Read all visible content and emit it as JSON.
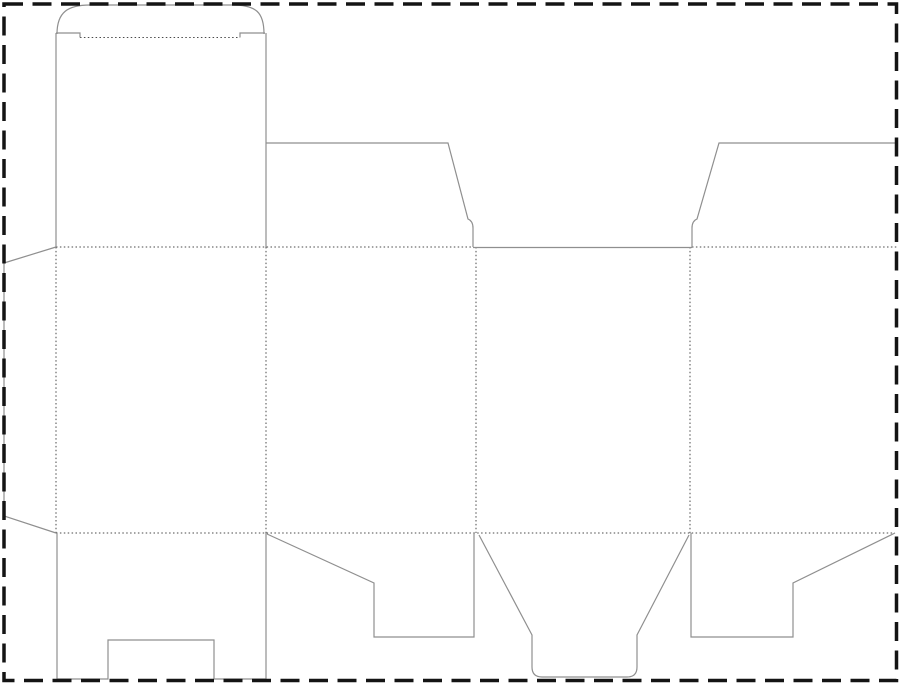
{
  "canvas": {
    "width": 900,
    "height": 685,
    "background": "#ffffff"
  },
  "colors": {
    "cut_line": "#8f8f8f",
    "fold_line": "#4a4a4a",
    "border": "#141414",
    "background": "#ffffff"
  },
  "border": {
    "name": "dashed-page-border",
    "x": 4,
    "y": 4,
    "width": 892.5,
    "height": 676.5,
    "stroke_width": 3.5,
    "dash_pattern": "19 9.5"
  },
  "dieline": {
    "title": "folding-carton-box-dieline",
    "cut_stroke_width": 1.2,
    "fold_stroke_width": 1,
    "fold_dash_pattern": "1.5 2.4",
    "cut_paths": [
      {
        "name": "tuck-flap-arc",
        "d": "M 57 34 C 57 12 68 5 90 5 L 232 5 C 256 5 264 12 264 34"
      },
      {
        "name": "tuck-slit-left",
        "d": "M 56 33 L 80 33 L 80 37.5"
      },
      {
        "name": "tuck-slit-right",
        "d": "M 240 37.5 L 240 33 L 265 33"
      },
      {
        "name": "panel1-left-edge",
        "d": "M 56 33 L 56 247"
      },
      {
        "name": "panel1-right-edge",
        "d": "M 266 33 L 266 247"
      },
      {
        "name": "glue-flap-outline",
        "d": "M 56 247 L 4 263 L 4 516 L 56 533"
      },
      {
        "name": "top-dust-flap-left",
        "d": "M 266 143 L 448 143 L 468 219 Q 473 221 473 228 L 473 247"
      },
      {
        "name": "panel3-top-cut",
        "d": "M 473 247.5 L 692 247.5"
      },
      {
        "name": "top-dust-flap-right",
        "d": "M 692 247 L 692 228 Q 692 221 697 219 L 719 143 L 897 143"
      },
      {
        "name": "bottom-flap-panel1",
        "d": "M 57 533 L 57 679 L 108 679 L 108 640 L 214 640 L 214 679 L 266 679 L 266 533"
      },
      {
        "name": "bottom-flap-panel2",
        "d": "M 267 534 L 374 583 L 374 637 L 474 637 L 474 533"
      },
      {
        "name": "bottom-tuck-flap-panel3",
        "d": "M 479 535 L 532 635 L 532 667 Q 532 677 542 677 L 627 677 Q 637 677 637 667 L 637 635 L 689 535"
      },
      {
        "name": "bottom-flap-panel4",
        "d": "M 691 533 L 691 637 L 793 637 L 793 583 L 895 533"
      }
    ],
    "fold_lines": [
      {
        "name": "tuck-fold",
        "x1": 80,
        "y1": 37.5,
        "x2": 240,
        "y2": 37.5
      },
      {
        "name": "top-fold-left-span",
        "x1": 56,
        "y1": 247,
        "x2": 473,
        "y2": 247
      },
      {
        "name": "top-fold-right-span",
        "x1": 692,
        "y1": 247,
        "x2": 897,
        "y2": 247
      },
      {
        "name": "bottom-fold-span",
        "x1": 56,
        "y1": 533,
        "x2": 895,
        "y2": 533
      },
      {
        "name": "glue-flap-fold",
        "x1": 56,
        "y1": 247,
        "x2": 56,
        "y2": 533
      },
      {
        "name": "panel1-panel2-fold",
        "x1": 266,
        "y1": 247,
        "x2": 266,
        "y2": 533
      },
      {
        "name": "panel2-panel3-fold",
        "x1": 476,
        "y1": 247,
        "x2": 476,
        "y2": 533
      },
      {
        "name": "panel3-panel4-fold",
        "x1": 690,
        "y1": 247,
        "x2": 690,
        "y2": 533
      }
    ]
  }
}
